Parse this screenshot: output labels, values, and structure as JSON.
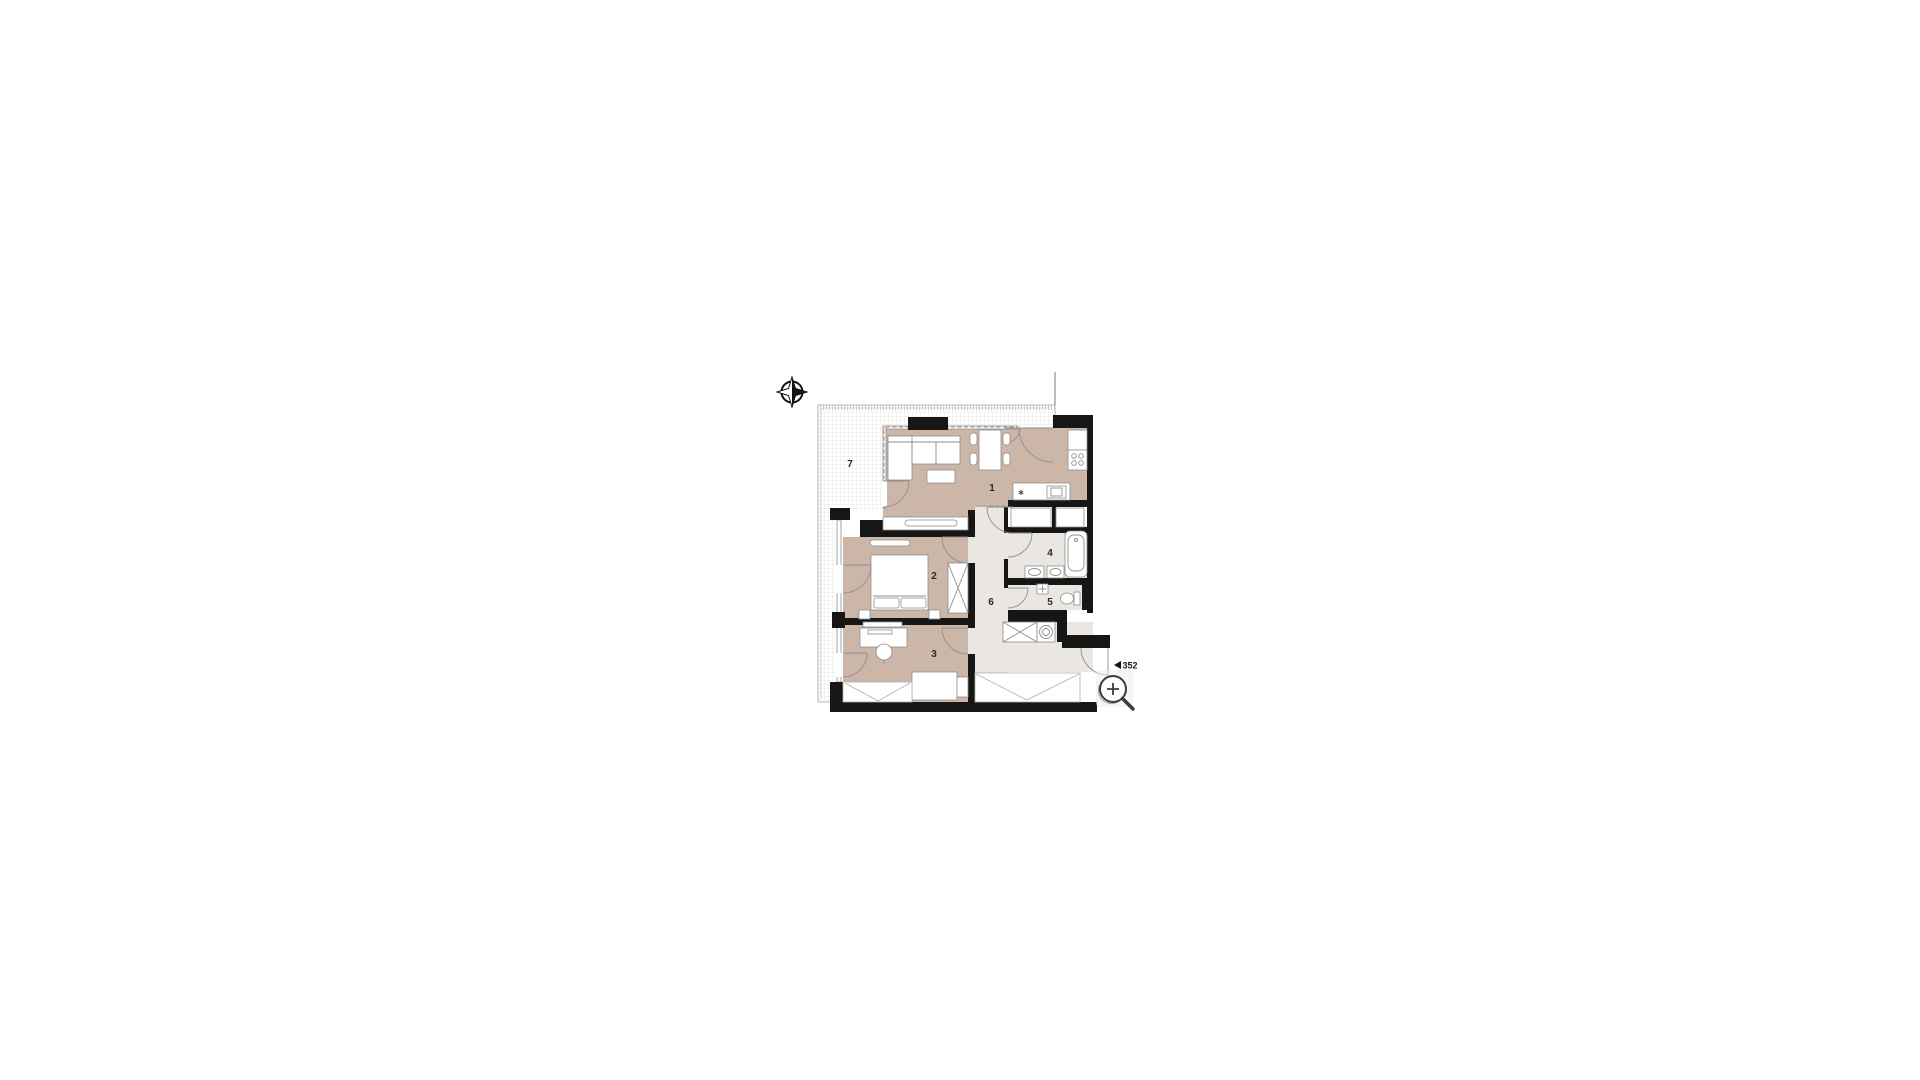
{
  "floor_plan": {
    "rooms": [
      {
        "number": "1"
      },
      {
        "number": "2"
      },
      {
        "number": "3"
      },
      {
        "number": "4"
      },
      {
        "number": "5"
      },
      {
        "number": "6"
      },
      {
        "number": "7"
      }
    ],
    "annotation": {
      "marker_value": "352"
    },
    "icons": {
      "compass": "north-arrow-icon",
      "magnifier": "zoom-in-icon",
      "marker": "left-triangle-icon"
    },
    "colors": {
      "room_fill": "#cbb6a8",
      "hall_fill": "#eae6e1",
      "wall": "#161616",
      "grid_line": "#e2dfda",
      "outline": "#8e8e8e",
      "label": "#2a2a2a"
    }
  }
}
